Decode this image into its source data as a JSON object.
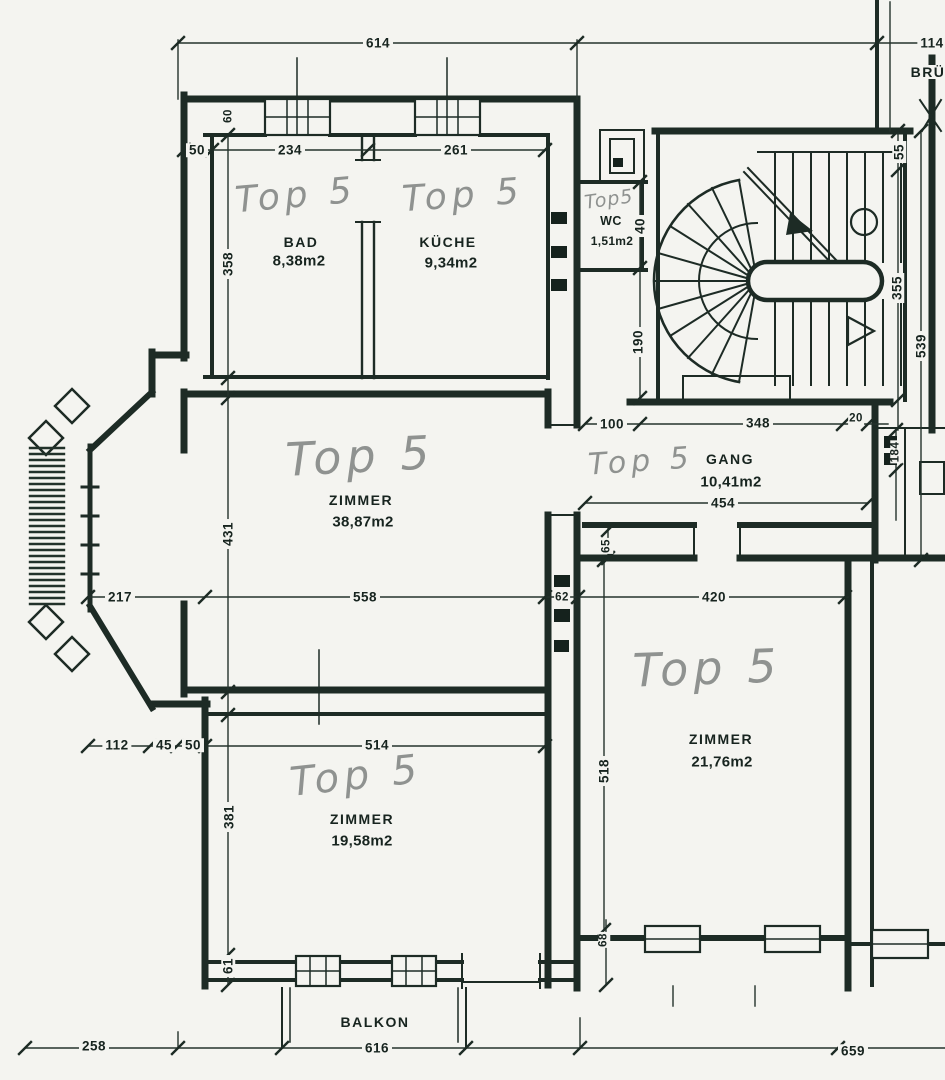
{
  "plan": {
    "handwritten_unit": "Top 5",
    "rooms": [
      {
        "name": "BAD",
        "area": "8,38m2",
        "handwritten": "Top 5"
      },
      {
        "name": "KÜCHE",
        "area": "9,34m2",
        "handwritten": "Top 5"
      },
      {
        "name": "WC",
        "area": "1,51m2",
        "handwritten": "Top5"
      },
      {
        "name": "GANG",
        "area": "10,41m2",
        "handwritten": "Top 5"
      },
      {
        "name": "ZIMMER",
        "area": "38,87m2",
        "handwritten": "Top 5"
      },
      {
        "name": "ZIMMER",
        "area": "21,76m2",
        "handwritten": "Top 5"
      },
      {
        "name": "ZIMMER",
        "area": "19,58m2",
        "handwritten": "Top 5"
      },
      {
        "name": "BALKON"
      }
    ],
    "partial_labels": {
      "top_right": "BRÜ"
    },
    "dimensions": {
      "top_total": "614",
      "top_right_cut": "114",
      "top_row": [
        "50",
        "234",
        "261"
      ],
      "window_pier": "60",
      "left_col": [
        "358",
        "431",
        "381",
        "61"
      ],
      "wc_col": [
        "40",
        "190"
      ],
      "stair_col": [
        "55",
        "355",
        "539"
      ],
      "gang_top": [
        "100",
        "348",
        "20"
      ],
      "gang_width": "454",
      "gang_right_col": "184",
      "mid_row": [
        "217",
        "558",
        "62",
        "420"
      ],
      "mid_wall": "65",
      "lower_row": [
        "112",
        "45",
        "50",
        "514"
      ],
      "right_room_height": "518",
      "lower_wall": "68",
      "bottom_row": [
        "258",
        "616",
        "659"
      ]
    }
  }
}
